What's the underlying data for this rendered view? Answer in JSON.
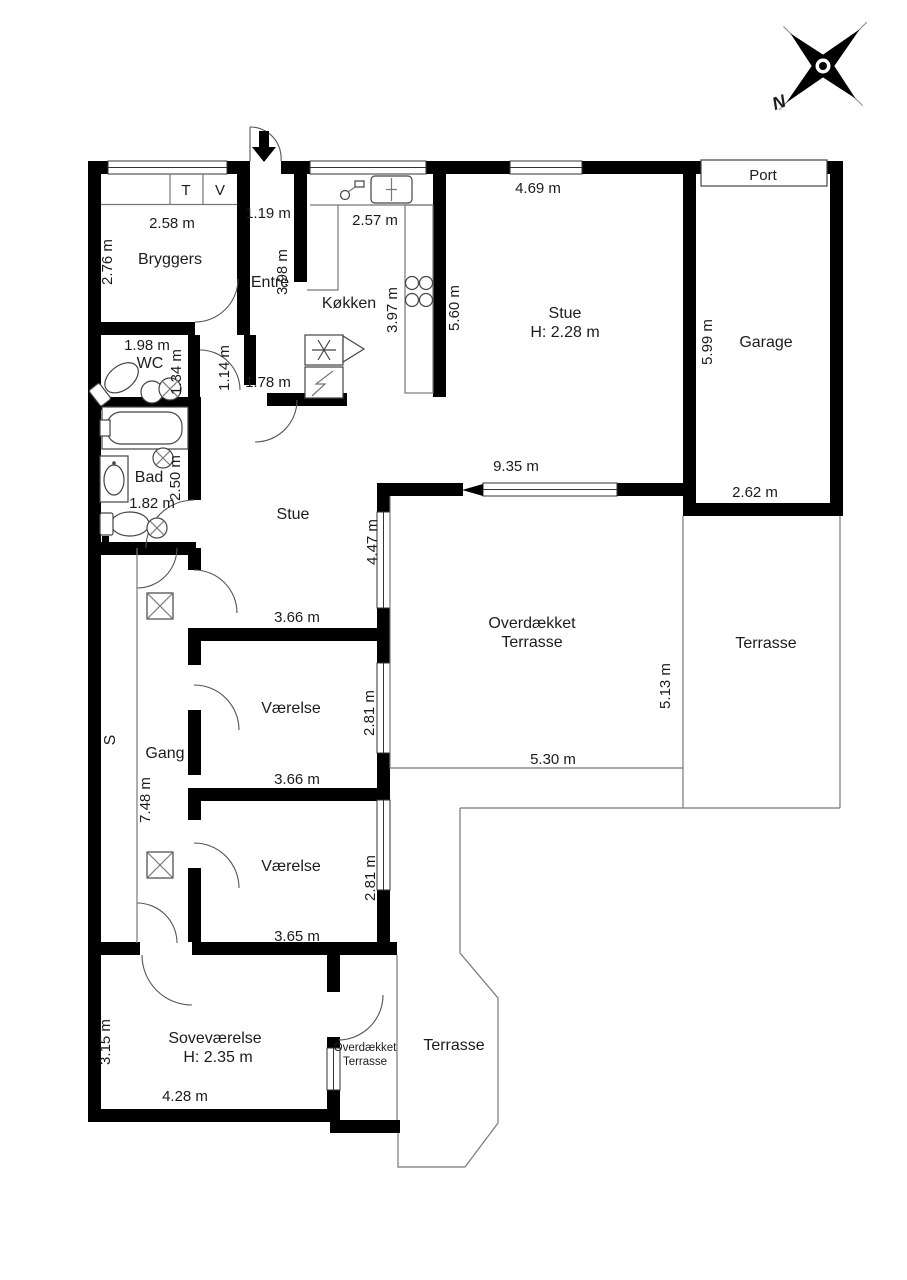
{
  "rooms": {
    "bryggers": {
      "label": "Bryggers",
      "width": "2.58 m",
      "depth": "2.76 m",
      "cabinet_t": "T",
      "cabinet_v": "V"
    },
    "entre": {
      "label": "Entre",
      "width": "1.19 m",
      "depth": "3.98 m"
    },
    "kokken": {
      "label": "Køkken",
      "width": "2.57 m",
      "depth": "3.97 m"
    },
    "stue_north": {
      "label": "Stue",
      "ceiling_height": "H: 2.28 m",
      "width": "4.69 m",
      "depth": "5.60 m"
    },
    "garage": {
      "label": "Garage",
      "depth": "5.99 m",
      "width": "2.62 m",
      "door_label": "Port"
    },
    "wc": {
      "label": "WC",
      "width": "1.98 m",
      "depth": "1.34 m"
    },
    "hall_nook": {
      "width": "1.14 m",
      "opening": "1.78 m"
    },
    "bad": {
      "label": "Bad",
      "depth": "2.50 m",
      "width": "1.82 m"
    },
    "stue_mid": {
      "label": "Stue",
      "window": "4.47 m"
    },
    "overdaekket_terrasse_east": {
      "label_line1": "Overdækket",
      "label_line2": "Terrasse",
      "width_top": "9.35 m",
      "depth_right": "5.13 m",
      "width_bottom": "5.30 m"
    },
    "terrasse_east": {
      "label": "Terrasse"
    },
    "vaerelse_north": {
      "label": "Værelse",
      "width_top": "3.66 m",
      "depth": "2.81 m",
      "width_bottom": "3.66 m"
    },
    "vaerelse_south": {
      "label": "Værelse",
      "depth": "2.81 m",
      "width_bottom": "3.65 m"
    },
    "skab": {
      "label": "S"
    },
    "gang": {
      "label": "Gang",
      "length": "7.48 m"
    },
    "sovevaerelse": {
      "label": "Soveværelse",
      "ceiling_height": "H: 2.35 m",
      "depth": "3.15 m",
      "width": "4.28 m"
    },
    "overdaekket_terrasse_south": {
      "label_line1": "Overdækket",
      "label_line2": "Terrasse"
    },
    "terrasse_south": {
      "label": "Terrasse"
    }
  },
  "compass": {
    "north": "N"
  },
  "colors": {
    "wall": "#000000",
    "background": "#ffffff",
    "thin_line": "#777777"
  }
}
